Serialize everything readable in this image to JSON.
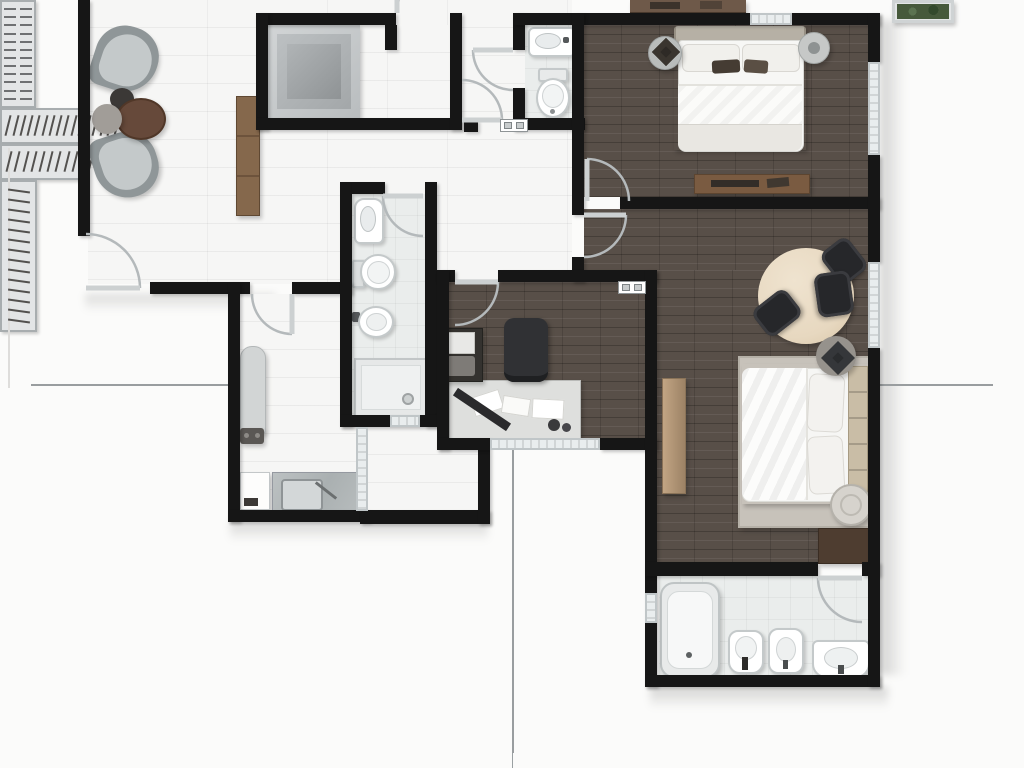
{
  "meta": {
    "kind": "apartment-floor-plan",
    "style": "top-down-3d-render",
    "units_text_visible": false
  },
  "palette": {
    "outside": "#fbfbfa",
    "wall": "#161616",
    "tile": "#f6f6f5",
    "bath": "#eaedec",
    "wood": "#584f48",
    "window": "#e9edee",
    "window_frame": "#c0c6c8",
    "door_arc": "#b4b9bb",
    "door_leaf": "#ccd0d1",
    "closet_bg": "#e3e5e6",
    "closet_border": "#a8adaf",
    "hanger": "#53514f",
    "table_wood": "#e7d8c0",
    "chair": "#26272a",
    "armchair_shell": "#8f9698",
    "armchair_cushion": "#c4c9ca",
    "wood_furniture": "#85684c",
    "rug": "#c7c2ba",
    "headboard": "#c9bda6",
    "plant": "#46593b",
    "fixborder": "#c4c9ca"
  },
  "rooms": [
    {
      "id": "living-room",
      "label": "living room",
      "floor": "tile",
      "furniture": [
        "armchair",
        "armchair",
        "coffee-table-dark",
        "coffee-table-brown",
        "coffee-table-gray",
        "sideboard"
      ]
    },
    {
      "id": "elevator",
      "label": "elevator shaft",
      "floor": "tile",
      "furniture": [
        "elevator-cab"
      ]
    },
    {
      "id": "hallway",
      "label": "hallway",
      "floor": "tile",
      "furniture": []
    },
    {
      "id": "wc",
      "label": "toilet room",
      "floor": "bath",
      "fixtures": [
        "washbasin",
        "toilet"
      ]
    },
    {
      "id": "bedroom-1",
      "label": "bedroom 1",
      "floor": "wood",
      "furniture": [
        "shelf-wardrobe",
        "double-bed",
        "nightstand-round",
        "nightstand-round",
        "dresser"
      ]
    },
    {
      "id": "master-suite",
      "label": "master suite",
      "floor": "wood",
      "furniture": [
        "closet-rail-top",
        "round-table",
        "chair",
        "chair",
        "chair",
        "double-bed",
        "bench",
        "stool",
        "stool-cushion",
        "closet-rail-bottom",
        "dark-cabinet"
      ]
    },
    {
      "id": "office",
      "label": "office",
      "floor": "wood",
      "furniture": [
        "desk",
        "office-chair",
        "printer-cabinet",
        "closet-rail"
      ]
    },
    {
      "id": "bathroom-main",
      "label": "main bathroom",
      "floor": "bath",
      "fixtures": [
        "washbasin",
        "toilet",
        "bidet",
        "shower"
      ]
    },
    {
      "id": "laundry",
      "label": "laundry room",
      "floor": "tile",
      "furniture": [
        "ironing-board",
        "counter-with-sink",
        "washer"
      ]
    },
    {
      "id": "service-nook",
      "label": "service nook",
      "floor": "tile",
      "furniture": []
    },
    {
      "id": "bathroom-suite",
      "label": "suite bathroom",
      "floor": "bath",
      "fixtures": [
        "bathtub",
        "toilet",
        "bidet",
        "vanity-sink"
      ]
    }
  ],
  "closets": {
    "suite_top_hangers": 21,
    "suite_bottom_hangers": 18,
    "office_hangers": 14,
    "bedroom1_shelf_slats": 12
  },
  "doors": [
    "entrance",
    "laundry",
    "elevator",
    "wc",
    "vestibule",
    "bedroom-1",
    "master-suite",
    "office",
    "bathroom-main",
    "bathroom-suite"
  ],
  "windows": [
    "bedroom-1-right",
    "bedroom-1-top",
    "master-suite-right",
    "office-bottom",
    "laundry-right",
    "bathroom-main-bottom",
    "suite-bathroom-left"
  ],
  "exterior_items": [
    "planter-box",
    "balcony-cabinet"
  ]
}
